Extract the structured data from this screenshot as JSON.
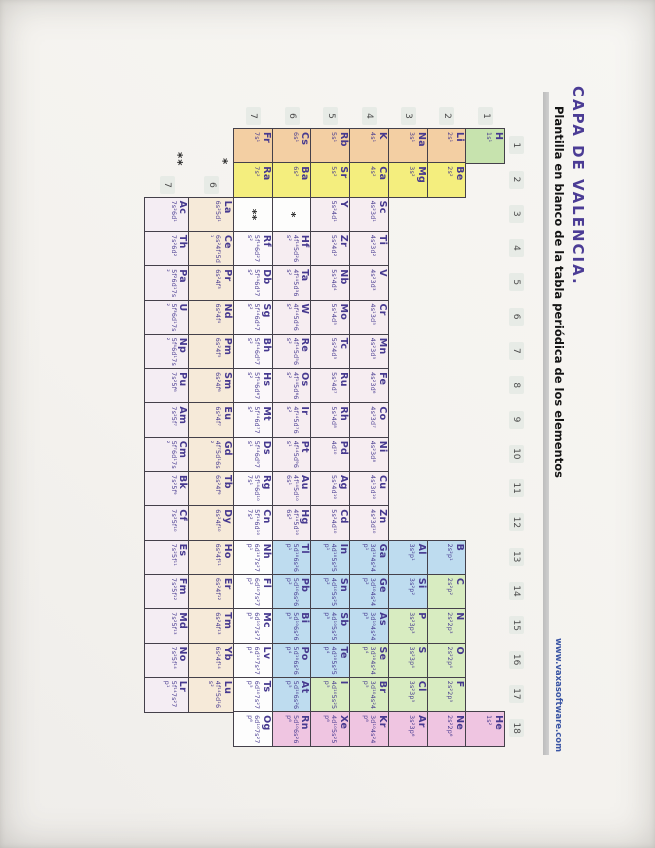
{
  "header": {
    "title": "CAPA DE VALENCIA.",
    "subtitle": "Plantilla en blanco de la tabla periódica de los elementos",
    "url": "www.vaxasoftware.com"
  },
  "axis": {
    "groups": [
      "1",
      "2",
      "3",
      "4",
      "5",
      "6",
      "7",
      "8",
      "9",
      "10",
      "11",
      "12",
      "13",
      "14",
      "15",
      "16",
      "17",
      "18"
    ],
    "periods": [
      "1",
      "2",
      "3",
      "4",
      "5",
      "6",
      "7"
    ],
    "lanthanide_row_label": "6",
    "actinide_row_label": "7",
    "lanthanide_marker": "*",
    "actinide_marker": "**"
  },
  "colors": {
    "h": "#c7e3ae",
    "alk": "#f3cfa3",
    "alke": "#f4ee7e",
    "tm": "#f6edf1",
    "tm7": "#fbf8fa",
    "pb": "#bedcef",
    "nm": "#d8ecc1",
    "ng": "#efc5e1",
    "unk": "#fdfdfd",
    "lan": "#f6ead9",
    "act": "#f4edf3",
    "ink": "#46398f",
    "border": "#44404a",
    "rule": "#c6c6c6",
    "url_blue": "#3a55a4"
  },
  "placeholders": [
    {
      "per": 6,
      "grp": 3,
      "text": "*"
    },
    {
      "per": 7,
      "grp": 3,
      "text": "**"
    }
  ],
  "elements": [
    {
      "sym": "H",
      "per": 1,
      "grp": 1,
      "cat": "h",
      "cfg": "1s¹"
    },
    {
      "sym": "He",
      "per": 1,
      "grp": 18,
      "cat": "ng",
      "cfg": "1s²"
    },
    {
      "sym": "Li",
      "per": 2,
      "grp": 1,
      "cat": "alk",
      "cfg": "2s¹"
    },
    {
      "sym": "Be",
      "per": 2,
      "grp": 2,
      "cat": "alke",
      "cfg": "2s²"
    },
    {
      "sym": "B",
      "per": 2,
      "grp": 13,
      "cat": "pb",
      "cfg": "2s²p¹"
    },
    {
      "sym": "C",
      "per": 2,
      "grp": 14,
      "cat": "nm",
      "cfg": "2s²p²"
    },
    {
      "sym": "N",
      "per": 2,
      "grp": 15,
      "cat": "nm",
      "cfg": "2s²2p³"
    },
    {
      "sym": "O",
      "per": 2,
      "grp": 16,
      "cat": "nm",
      "cfg": "2s²2p⁴"
    },
    {
      "sym": "F",
      "per": 2,
      "grp": 17,
      "cat": "nm",
      "cfg": "2s²2p⁵"
    },
    {
      "sym": "Ne",
      "per": 2,
      "grp": 18,
      "cat": "ng",
      "cfg": "2s²2p⁶"
    },
    {
      "sym": "Na",
      "per": 3,
      "grp": 1,
      "cat": "alk",
      "cfg": "3s¹"
    },
    {
      "sym": "Mg",
      "per": 3,
      "grp": 2,
      "cat": "alke",
      "cfg": "3s²"
    },
    {
      "sym": "Al",
      "per": 3,
      "grp": 13,
      "cat": "pb",
      "cfg": "3s²p¹"
    },
    {
      "sym": "Si",
      "per": 3,
      "grp": 14,
      "cat": "pb",
      "cfg": "3s²p²"
    },
    {
      "sym": "P",
      "per": 3,
      "grp": 15,
      "cat": "nm",
      "cfg": "3s²3p³"
    },
    {
      "sym": "S",
      "per": 3,
      "grp": 16,
      "cat": "nm",
      "cfg": "3s²3p⁴"
    },
    {
      "sym": "Cl",
      "per": 3,
      "grp": 17,
      "cat": "nm",
      "cfg": "3s²3p⁵"
    },
    {
      "sym": "Ar",
      "per": 3,
      "grp": 18,
      "cat": "ng",
      "cfg": "3s²3p⁶"
    },
    {
      "sym": "K",
      "per": 4,
      "grp": 1,
      "cat": "alk",
      "cfg": "4s¹"
    },
    {
      "sym": "Ca",
      "per": 4,
      "grp": 2,
      "cat": "alke",
      "cfg": "4s²"
    },
    {
      "sym": "Sc",
      "per": 4,
      "grp": 3,
      "cat": "tm",
      "cfg": "4s²3d¹"
    },
    {
      "sym": "Ti",
      "per": 4,
      "grp": 4,
      "cat": "tm",
      "cfg": "4s²3d²"
    },
    {
      "sym": "V",
      "per": 4,
      "grp": 5,
      "cat": "tm",
      "cfg": "4s²3d³"
    },
    {
      "sym": "Cr",
      "per": 4,
      "grp": 6,
      "cat": "tm",
      "cfg": "4s¹3d⁵"
    },
    {
      "sym": "Mn",
      "per": 4,
      "grp": 7,
      "cat": "tm",
      "cfg": "4s²3d⁵"
    },
    {
      "sym": "Fe",
      "per": 4,
      "grp": 8,
      "cat": "tm",
      "cfg": "4s²3d⁶"
    },
    {
      "sym": "Co",
      "per": 4,
      "grp": 9,
      "cat": "tm",
      "cfg": "4s²3d⁷"
    },
    {
      "sym": "Ni",
      "per": 4,
      "grp": 10,
      "cat": "tm",
      "cfg": "4s²3d⁸"
    },
    {
      "sym": "Cu",
      "per": 4,
      "grp": 11,
      "cat": "tm",
      "cfg": "4s¹3d¹⁰"
    },
    {
      "sym": "Zn",
      "per": 4,
      "grp": 12,
      "cat": "tm",
      "cfg": "4s²3d¹⁰"
    },
    {
      "sym": "Ga",
      "per": 4,
      "grp": 13,
      "cat": "pb",
      "cfg": "3d¹⁰4s²4p¹"
    },
    {
      "sym": "Ge",
      "per": 4,
      "grp": 14,
      "cat": "pb",
      "cfg": "3d¹⁰4s²4p²"
    },
    {
      "sym": "As",
      "per": 4,
      "grp": 15,
      "cat": "pb",
      "cfg": "3d¹⁰4s²4p³"
    },
    {
      "sym": "Se",
      "per": 4,
      "grp": 16,
      "cat": "nm",
      "cfg": "3d¹⁰4s²4p⁴"
    },
    {
      "sym": "Br",
      "per": 4,
      "grp": 17,
      "cat": "nm",
      "cfg": "3d¹⁰4s²4p⁵"
    },
    {
      "sym": "Kr",
      "per": 4,
      "grp": 18,
      "cat": "ng",
      "cfg": "3d¹⁰4s²4p⁶"
    },
    {
      "sym": "Rb",
      "per": 5,
      "grp": 1,
      "cat": "alk",
      "cfg": "5s¹"
    },
    {
      "sym": "Sr",
      "per": 5,
      "grp": 2,
      "cat": "alke",
      "cfg": "5s²"
    },
    {
      "sym": "Y",
      "per": 5,
      "grp": 3,
      "cat": "tm",
      "cfg": "5s²4d¹"
    },
    {
      "sym": "Zr",
      "per": 5,
      "grp": 4,
      "cat": "tm",
      "cfg": "5s²4d²"
    },
    {
      "sym": "Nb",
      "per": 5,
      "grp": 5,
      "cat": "tm",
      "cfg": "5s¹4d⁴"
    },
    {
      "sym": "Mo",
      "per": 5,
      "grp": 6,
      "cat": "tm",
      "cfg": "5s¹4d⁵"
    },
    {
      "sym": "Tc",
      "per": 5,
      "grp": 7,
      "cat": "tm",
      "cfg": "5s²4d⁵"
    },
    {
      "sym": "Ru",
      "per": 5,
      "grp": 8,
      "cat": "tm",
      "cfg": "5s¹4d⁷"
    },
    {
      "sym": "Rh",
      "per": 5,
      "grp": 9,
      "cat": "tm",
      "cfg": "5s¹4d⁸"
    },
    {
      "sym": "Pd",
      "per": 5,
      "grp": 10,
      "cat": "tm",
      "cfg": "4d¹⁰"
    },
    {
      "sym": "Ag",
      "per": 5,
      "grp": 11,
      "cat": "tm",
      "cfg": "5s¹4d¹⁰"
    },
    {
      "sym": "Cd",
      "per": 5,
      "grp": 12,
      "cat": "tm",
      "cfg": "5s²4d¹⁰"
    },
    {
      "sym": "In",
      "per": 5,
      "grp": 13,
      "cat": "pb",
      "cfg": "4d¹⁰5s²5p¹"
    },
    {
      "sym": "Sn",
      "per": 5,
      "grp": 14,
      "cat": "pb",
      "cfg": "4d¹⁰5s²5p²"
    },
    {
      "sym": "Sb",
      "per": 5,
      "grp": 15,
      "cat": "pb",
      "cfg": "4d¹⁰5s²5p³"
    },
    {
      "sym": "Te",
      "per": 5,
      "grp": 16,
      "cat": "pb",
      "cfg": "4d¹⁰5s²5p⁴"
    },
    {
      "sym": "I",
      "per": 5,
      "grp": 17,
      "cat": "nm",
      "cfg": "4d¹⁰5s²5p⁵"
    },
    {
      "sym": "Xe",
      "per": 5,
      "grp": 18,
      "cat": "ng",
      "cfg": "4d¹⁰5s²5p⁶"
    },
    {
      "sym": "Cs",
      "per": 6,
      "grp": 1,
      "cat": "alk",
      "cfg": "6s¹"
    },
    {
      "sym": "Ba",
      "per": 6,
      "grp": 2,
      "cat": "alke",
      "cfg": "6s²"
    },
    {
      "sym": "Hf",
      "per": 6,
      "grp": 4,
      "cat": "tm",
      "cfg": "4f¹⁴5d²6s²"
    },
    {
      "sym": "Ta",
      "per": 6,
      "grp": 5,
      "cat": "tm",
      "cfg": "4f¹⁴5d³6s²"
    },
    {
      "sym": "W",
      "per": 6,
      "grp": 6,
      "cat": "tm",
      "cfg": "4f¹⁴5d⁴6s²"
    },
    {
      "sym": "Re",
      "per": 6,
      "grp": 7,
      "cat": "tm",
      "cfg": "4f¹⁴5d⁵6s²"
    },
    {
      "sym": "Os",
      "per": 6,
      "grp": 8,
      "cat": "tm",
      "cfg": "4f¹⁴5d⁶6s²"
    },
    {
      "sym": "Ir",
      "per": 6,
      "grp": 9,
      "cat": "tm",
      "cfg": "4f¹⁴5d⁷6s²"
    },
    {
      "sym": "Pt",
      "per": 6,
      "grp": 10,
      "cat": "tm",
      "cfg": "4f¹⁴5d⁹6s¹"
    },
    {
      "sym": "Au",
      "per": 6,
      "grp": 11,
      "cat": "tm",
      "cfg": "4f¹⁴5d¹⁰6s¹"
    },
    {
      "sym": "Hg",
      "per": 6,
      "grp": 12,
      "cat": "tm",
      "cfg": "4f¹⁴5d¹⁰6s²"
    },
    {
      "sym": "Tl",
      "per": 6,
      "grp": 13,
      "cat": "pb",
      "cfg": "5d¹⁰6s²6p¹"
    },
    {
      "sym": "Pb",
      "per": 6,
      "grp": 14,
      "cat": "pb",
      "cfg": "5d¹⁰6s²6p²"
    },
    {
      "sym": "Bi",
      "per": 6,
      "grp": 15,
      "cat": "pb",
      "cfg": "5d¹⁰6s²6p³"
    },
    {
      "sym": "Po",
      "per": 6,
      "grp": 16,
      "cat": "pb",
      "cfg": "5d¹⁰6s²6p⁴"
    },
    {
      "sym": "At",
      "per": 6,
      "grp": 17,
      "cat": "pb",
      "cfg": "5d¹⁰6s²6p⁵"
    },
    {
      "sym": "Rn",
      "per": 6,
      "grp": 18,
      "cat": "ng",
      "cfg": "5d¹⁰6s²6p⁶"
    },
    {
      "sym": "Fr",
      "per": 7,
      "grp": 1,
      "cat": "alk",
      "cfg": "7s¹"
    },
    {
      "sym": "Ra",
      "per": 7,
      "grp": 2,
      "cat": "alke",
      "cfg": "7s²"
    },
    {
      "sym": "Rf",
      "per": 7,
      "grp": 4,
      "cat": "tm7",
      "cfg": "5f¹⁴6d²7s²"
    },
    {
      "sym": "Db",
      "per": 7,
      "grp": 5,
      "cat": "tm7",
      "cfg": "5f¹⁴6d³7s²"
    },
    {
      "sym": "Sg",
      "per": 7,
      "grp": 6,
      "cat": "tm7",
      "cfg": "5f¹⁴6d⁴7s²"
    },
    {
      "sym": "Bh",
      "per": 7,
      "grp": 7,
      "cat": "tm7",
      "cfg": "5f¹⁴6d⁵7s²"
    },
    {
      "sym": "Hs",
      "per": 7,
      "grp": 8,
      "cat": "tm7",
      "cfg": "5f¹⁴6d⁶7s²"
    },
    {
      "sym": "Mt",
      "per": 7,
      "grp": 9,
      "cat": "tm7",
      "cfg": "5f¹⁴6d⁷7s²"
    },
    {
      "sym": "Ds",
      "per": 7,
      "grp": 10,
      "cat": "tm7",
      "cfg": "5f¹⁴6d⁹7s¹"
    },
    {
      "sym": "Rg",
      "per": 7,
      "grp": 11,
      "cat": "tm7",
      "cfg": "5f¹⁴6d¹⁰7s¹"
    },
    {
      "sym": "Cn",
      "per": 7,
      "grp": 12,
      "cat": "tm7",
      "cfg": "5f¹⁴6d¹⁰7s²"
    },
    {
      "sym": "Nh",
      "per": 7,
      "grp": 13,
      "cat": "unk",
      "cfg": "6d¹⁰7s²7p¹"
    },
    {
      "sym": "Fl",
      "per": 7,
      "grp": 14,
      "cat": "unk",
      "cfg": "6d¹⁰7s²7p²"
    },
    {
      "sym": "Mc",
      "per": 7,
      "grp": 15,
      "cat": "unk",
      "cfg": "6d¹⁰7s²7p³"
    },
    {
      "sym": "Lv",
      "per": 7,
      "grp": 16,
      "cat": "unk",
      "cfg": "6d¹⁰7s²7p⁴"
    },
    {
      "sym": "Ts",
      "per": 7,
      "grp": 17,
      "cat": "unk",
      "cfg": "6d¹⁰7s²7p⁵"
    },
    {
      "sym": "Og",
      "per": 7,
      "grp": 18,
      "cat": "unk",
      "cfg": "6d¹⁰7s²7p⁶"
    },
    {
      "sym": "La",
      "row": "lan",
      "grp": 1,
      "cat": "lan",
      "cfg": "6s²5d¹"
    },
    {
      "sym": "Ce",
      "row": "lan",
      "grp": 2,
      "cat": "lan",
      "cfg": "6s²4f¹5d¹"
    },
    {
      "sym": "Pr",
      "row": "lan",
      "grp": 3,
      "cat": "lan",
      "cfg": "6s²4f³"
    },
    {
      "sym": "Nd",
      "row": "lan",
      "grp": 4,
      "cat": "lan",
      "cfg": "6s²4f⁴"
    },
    {
      "sym": "Pm",
      "row": "lan",
      "grp": 5,
      "cat": "lan",
      "cfg": "6s²4f⁵"
    },
    {
      "sym": "Sm",
      "row": "lan",
      "grp": 6,
      "cat": "lan",
      "cfg": "6s²4f⁶"
    },
    {
      "sym": "Eu",
      "row": "lan",
      "grp": 7,
      "cat": "lan",
      "cfg": "6s²4f⁷"
    },
    {
      "sym": "Gd",
      "row": "lan",
      "grp": 8,
      "cat": "lan",
      "cfg": "4f⁷5d¹6s²"
    },
    {
      "sym": "Tb",
      "row": "lan",
      "grp": 9,
      "cat": "lan",
      "cfg": "6s²4f⁹"
    },
    {
      "sym": "Dy",
      "row": "lan",
      "grp": 10,
      "cat": "lan",
      "cfg": "6s²4f¹⁰"
    },
    {
      "sym": "Ho",
      "row": "lan",
      "grp": 11,
      "cat": "lan",
      "cfg": "6s²4f¹¹"
    },
    {
      "sym": "Er",
      "row": "lan",
      "grp": 12,
      "cat": "lan",
      "cfg": "6s²4f¹²"
    },
    {
      "sym": "Tm",
      "row": "lan",
      "grp": 13,
      "cat": "lan",
      "cfg": "6s²4f¹³"
    },
    {
      "sym": "Yb",
      "row": "lan",
      "grp": 14,
      "cat": "lan",
      "cfg": "6s²4f¹⁴"
    },
    {
      "sym": "Lu",
      "row": "lan",
      "grp": 15,
      "cat": "lan",
      "cfg": "4f¹⁴5d¹6s²"
    },
    {
      "sym": "Ac",
      "row": "act",
      "grp": 1,
      "cat": "act",
      "cfg": "7s²6d¹"
    },
    {
      "sym": "Th",
      "row": "act",
      "grp": 2,
      "cat": "act",
      "cfg": "7s²6d²"
    },
    {
      "sym": "Pa",
      "row": "act",
      "grp": 3,
      "cat": "act",
      "cfg": "5f²6d¹7s²"
    },
    {
      "sym": "U",
      "row": "act",
      "grp": 4,
      "cat": "act",
      "cfg": "5f³6d¹7s²"
    },
    {
      "sym": "Np",
      "row": "act",
      "grp": 5,
      "cat": "act",
      "cfg": "5f⁴6d¹7s²"
    },
    {
      "sym": "Pu",
      "row": "act",
      "grp": 6,
      "cat": "act",
      "cfg": "7s²5f⁶"
    },
    {
      "sym": "Am",
      "row": "act",
      "grp": 7,
      "cat": "act",
      "cfg": "7s²5f⁷"
    },
    {
      "sym": "Cm",
      "row": "act",
      "grp": 8,
      "cat": "act",
      "cfg": "5f⁷6d¹7s²"
    },
    {
      "sym": "Bk",
      "row": "act",
      "grp": 9,
      "cat": "act",
      "cfg": "7s²5f⁹"
    },
    {
      "sym": "Cf",
      "row": "act",
      "grp": 10,
      "cat": "act",
      "cfg": "7s²5f¹⁰"
    },
    {
      "sym": "Es",
      "row": "act",
      "grp": 11,
      "cat": "act",
      "cfg": "7s²5f¹¹"
    },
    {
      "sym": "Fm",
      "row": "act",
      "grp": 12,
      "cat": "act",
      "cfg": "7s²5f¹²"
    },
    {
      "sym": "Md",
      "row": "act",
      "grp": 13,
      "cat": "act",
      "cfg": "7s²5f¹³"
    },
    {
      "sym": "No",
      "row": "act",
      "grp": 14,
      "cat": "act",
      "cfg": "7s²5f¹⁴"
    },
    {
      "sym": "Lr",
      "row": "act",
      "grp": 15,
      "cat": "act",
      "cfg": "5f¹⁴7s²7p¹"
    }
  ]
}
